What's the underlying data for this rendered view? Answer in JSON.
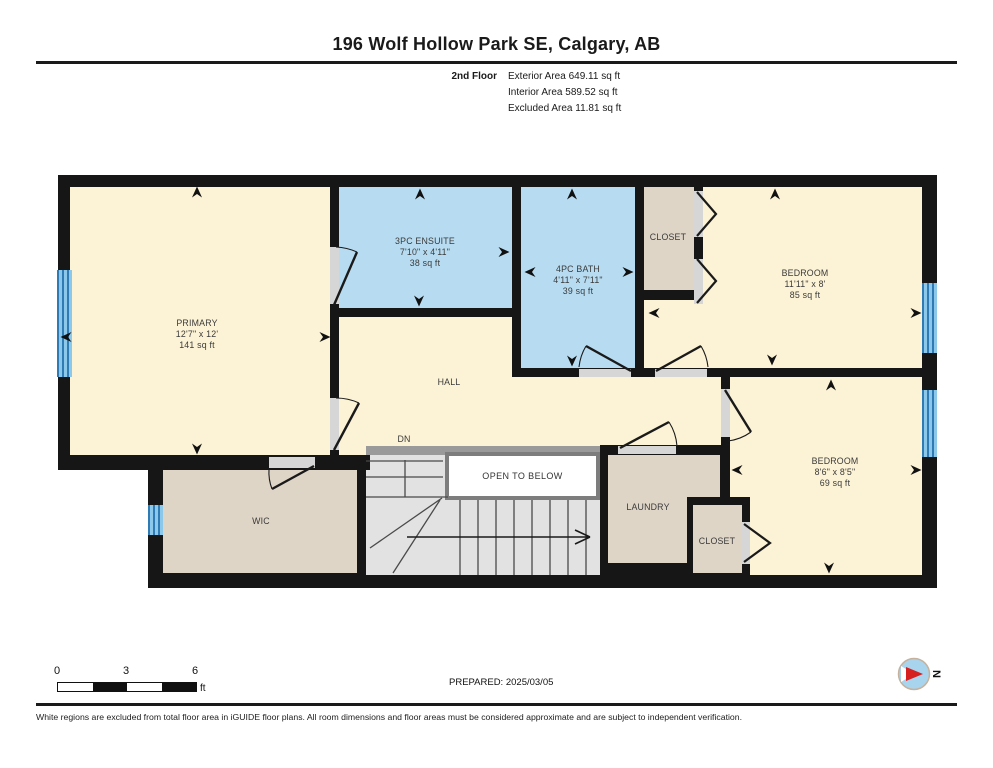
{
  "header": {
    "title": "196 Wolf Hollow Park SE, Calgary, AB",
    "floor_label": "2nd Floor",
    "exterior_area": "Exterior Area 649.11 sq ft",
    "interior_area": "Interior Area 589.52 sq ft",
    "excluded_area": "Excluded Area 11.81 sq ft"
  },
  "rooms": {
    "primary": {
      "name": "PRIMARY",
      "dims": "12'7\" x 12'",
      "area": "141 sq ft"
    },
    "ensuite": {
      "name": "3PC ENSUITE",
      "dims": "7'10\" x 4'11\"",
      "area": "38 sq ft"
    },
    "bath": {
      "name": "4PC BATH",
      "dims": "4'11\" x 7'11\"",
      "area": "39 sq ft"
    },
    "bedroom_top": {
      "name": "BEDROOM",
      "dims": "11'11\" x 8'",
      "area": "85 sq ft"
    },
    "bedroom_bottom": {
      "name": "BEDROOM",
      "dims": "8'6\" x 8'5\"",
      "area": "69 sq ft"
    },
    "closet_top": {
      "name": "CLOSET"
    },
    "closet_bottom": {
      "name": "CLOSET"
    },
    "laundry": {
      "name": "LAUNDRY"
    },
    "wic": {
      "name": "WIC"
    },
    "hall": {
      "name": "HALL"
    },
    "stairs_down": {
      "name": "DN"
    },
    "open_to_below": {
      "name": "OPEN TO BELOW"
    }
  },
  "footer": {
    "prepared": "PREPARED: 2025/03/05",
    "scale": {
      "tick0": "0",
      "tick3": "3",
      "tick6": "6",
      "unit": "ft"
    },
    "compass": {
      "north": "N"
    },
    "disclaimer": "White regions are excluded from total floor area in iGUIDE floor plans. All room dimensions and floor areas must be considered approximate and are subject to independent verification."
  },
  "colors": {
    "wall": "#161616",
    "room_cream": "#fcf2d5",
    "room_blue": "#b7dcf1",
    "room_tan": "#dfd5c7",
    "stairs_grey": "#e2e2e2",
    "door_gap": "#d6d6d6",
    "window_blue": "#8cc8ea",
    "compass_red": "#d61f1f"
  }
}
